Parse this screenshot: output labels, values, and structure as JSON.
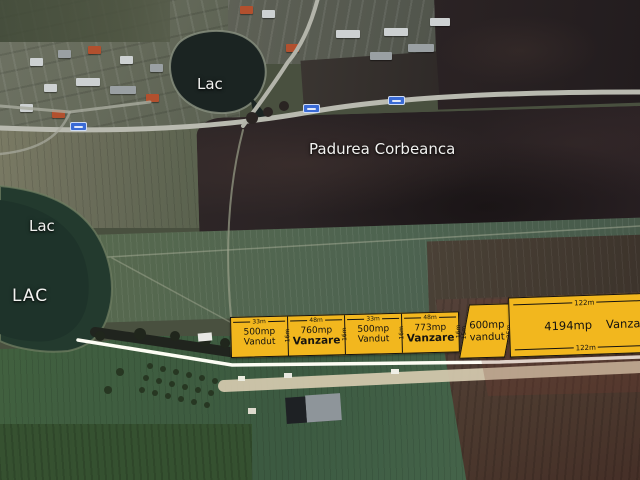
{
  "map_labels": {
    "lake_top": "Lac",
    "lake_left": "Lac",
    "lake_left_big": "LAC",
    "forest": "Padurea Corbeanca"
  },
  "parcels": {
    "small": [
      {
        "front": "33m",
        "area": "500mp",
        "status": "Vandut",
        "depth": "16m"
      },
      {
        "front": "48m",
        "area": "760mp",
        "status": "Vanzare",
        "depth": "16m"
      },
      {
        "front": "33m",
        "area": "500mp",
        "status": "Vandut",
        "depth": "16m"
      },
      {
        "front": "48m",
        "area": "773mp",
        "status": "Vanzare",
        "depth": "16m"
      }
    ],
    "trapezoid": {
      "area": "600mp",
      "status": "vandut",
      "depth_left": "15m",
      "depth_right": "35m"
    },
    "large": {
      "front_top": "122m",
      "front_bottom": "122m",
      "area": "4194mp",
      "status": "Vanzare"
    }
  },
  "colors": {
    "parcel_fill": "#F2B71E",
    "parcel_text": "#151310",
    "road_shield_blue": "#3A6BD6",
    "map_label_text": "#F2F2F0",
    "water_dark": "#1B2422",
    "forest_dark": "#2A2225"
  }
}
